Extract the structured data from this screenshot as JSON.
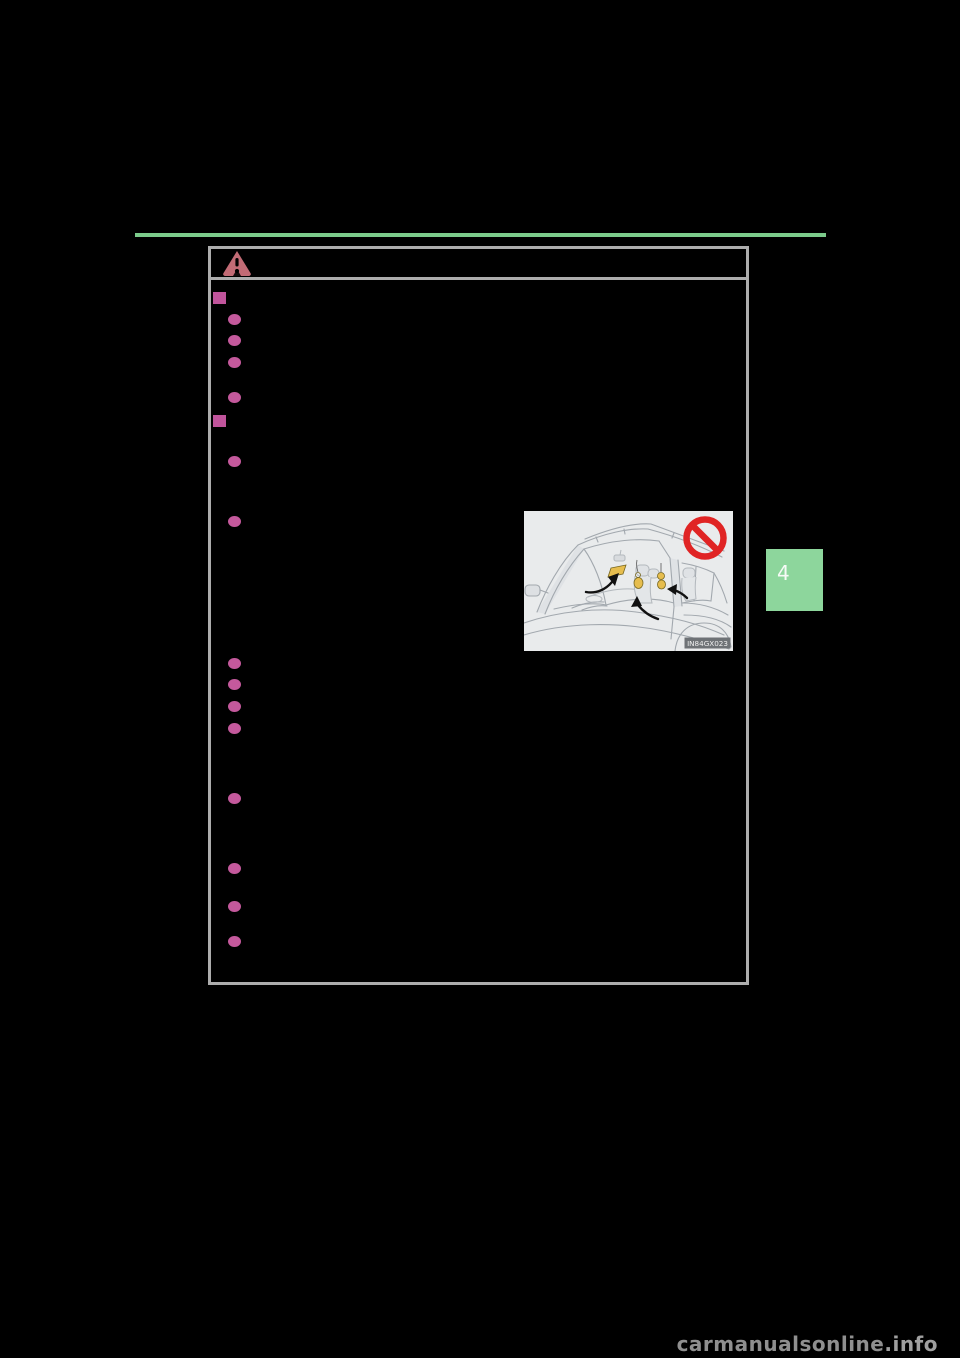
{
  "page": {
    "kind": "owner-manual-scanned-page",
    "chapter_tab": {
      "label": "4"
    },
    "watermark": {
      "site": "carmanualsonline",
      "tld": ".info"
    }
  },
  "caution_box": {
    "header_icon": "warning-triangle",
    "markers": {
      "square_section_markers": 2,
      "circle_bullets": 14
    },
    "note": "body text is printed black-on-black and not visible"
  },
  "figure": {
    "code_label": "IN84GX023",
    "depicts": "car interior with hanging accessories and air freshener, marked prohibited",
    "icons": [
      "prohibition-icon"
    ]
  },
  "colors": {
    "background": "#000000",
    "accent_rule_green": "#7ccb8b",
    "chapter_tab_green": "#8dd69c",
    "bullet_pink": "#c4599c",
    "caution_triangle_rose": "#c26b75",
    "frame_gray": "#adadad",
    "watermark_gray": "#8f8f8f",
    "prohibition_red": "#e02424",
    "accessory_yellow": "#e6bd4e",
    "figure_background": "#e9ebec"
  }
}
